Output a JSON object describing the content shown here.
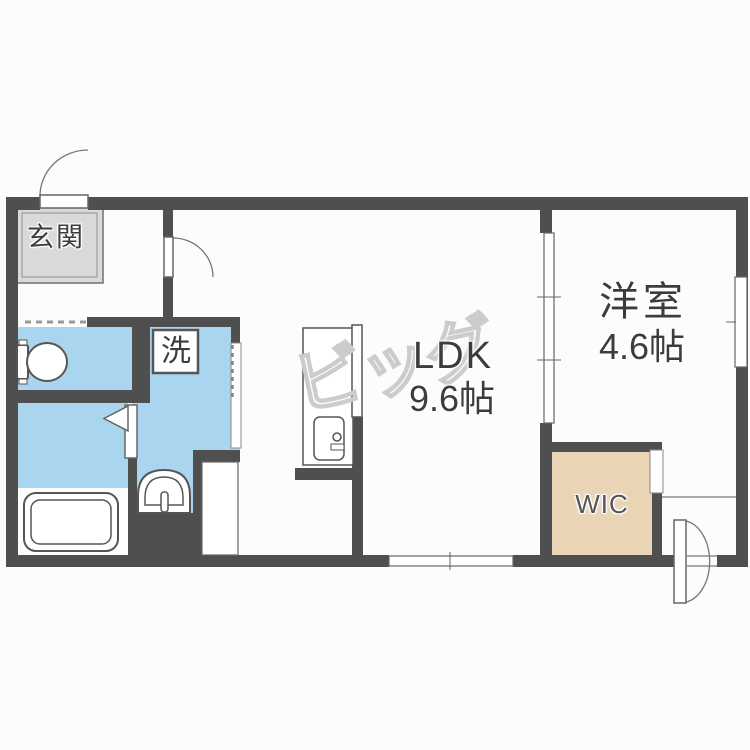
{
  "rooms": {
    "entrance": {
      "label": "玄関"
    },
    "ldk": {
      "name": "LDK",
      "size": "9.6帖"
    },
    "bedroom": {
      "name": "洋室",
      "size": "4.6帖"
    },
    "wic": {
      "label": "WIC"
    },
    "laundry": {
      "label": "洗"
    }
  },
  "watermark": {
    "text": "ビッグ"
  },
  "colors": {
    "wall": "#4f4f4f",
    "water": "#a9d6ee",
    "tile": "#d9d9d9",
    "closet": "#e9d5b5",
    "bg": "#fcfcfc",
    "ink": "#3c3c3c",
    "wm": "#cccccc"
  }
}
